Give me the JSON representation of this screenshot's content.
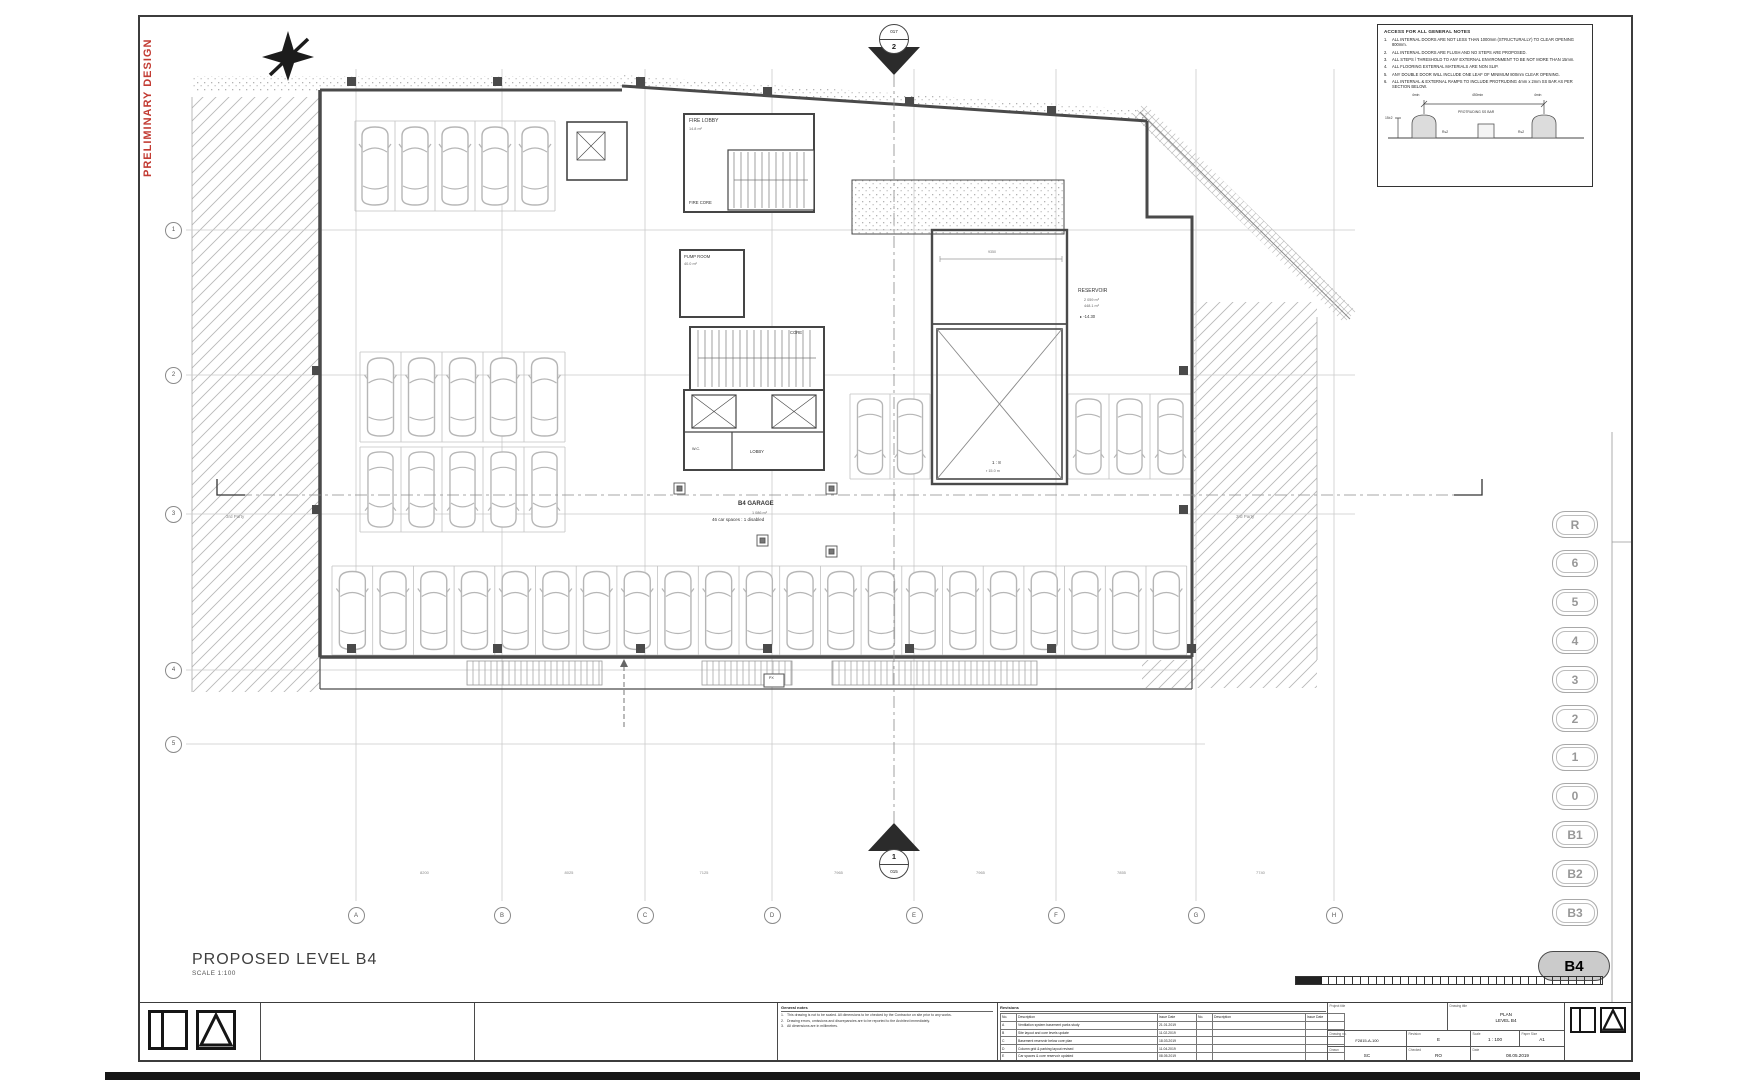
{
  "stamp": "PRELIMINARY DESIGN",
  "sheet_title": {
    "name": "PROPOSED LEVEL B4",
    "scale": "SCALE 1:100"
  },
  "section_markers": {
    "top_sheet": "017",
    "top_num": "2",
    "bottom_num": "1",
    "bottom_sheet": "015"
  },
  "grid": {
    "cols": [
      "A",
      "B",
      "C",
      "D",
      "E",
      "F",
      "G",
      "H"
    ],
    "rows": [
      "1",
      "2",
      "3",
      "4",
      "5"
    ]
  },
  "dims_bottom": [
    "8200",
    "8025",
    "7125",
    "7965",
    "7965",
    "7855",
    "7740"
  ],
  "notes_box": {
    "title": "ACCESS FOR ALL GENERAL NOTES",
    "items": [
      "ALL INTERNAL DOORS ARE NOT LESS THAN 1000mm (STRUCTURALLY) TO CLEAR OPENING 800mm.",
      "ALL INTERNAL DOORS ARE FLUSH AND NO STEPS ARE PROPOSED.",
      "ALL STEPS / THRESHOLD TO ANY EXTERNAL ENVIRONMENT TO BE NOT MORE THAN 15mm.",
      "ALL FLOORING EXTERNAL MATERIALS ARE NON SLIP.",
      "ANY DOUBLE DOOR WILL INCLUDE ONE LEAF OF MINIMUM 800mm CLEAR OPENING.",
      "ALL INTERNAL & EXTERNAL RAMPS TO INCLUDE PROTRUDING 4mm x 2mm SS BAR AS PER SECTION BELOW."
    ],
    "detail": {
      "dim_left": "4min",
      "dim_mid": "450min",
      "dim_right": "4min",
      "label": "PROTRUDING SS BAR",
      "side": "R≤2",
      "height": "15±2"
    }
  },
  "levels": [
    {
      "l": "R"
    },
    {
      "l": "6"
    },
    {
      "l": "5"
    },
    {
      "l": "4"
    },
    {
      "l": "3"
    },
    {
      "l": "2"
    },
    {
      "l": "1"
    },
    {
      "l": "0"
    },
    {
      "l": "B1"
    },
    {
      "l": "B2"
    },
    {
      "l": "B3"
    },
    {
      "l": "B4",
      "active": true
    }
  ],
  "plan_labels": [
    {
      "t": "FIRE LOBBY",
      "x": 549,
      "y": 102,
      "s": 5
    },
    {
      "t": "14.8 m²",
      "x": 549,
      "y": 110,
      "s": 3.8,
      "c": "#666"
    },
    {
      "t": "FIRE CORE",
      "x": 549,
      "y": 184,
      "s": 4.2
    },
    {
      "t": "PUMP ROOM",
      "x": 544,
      "y": 238,
      "s": 4.2
    },
    {
      "t": "40.0 m²",
      "x": 544,
      "y": 245,
      "s": 3.8,
      "c": "#666"
    },
    {
      "t": "CORE",
      "x": 650,
      "y": 314,
      "s": 4.2
    },
    {
      "t": "W.C.",
      "x": 552,
      "y": 430,
      "s": 3.8
    },
    {
      "t": "LOBBY",
      "x": 610,
      "y": 433,
      "s": 4.2
    },
    {
      "t": "B4 GARAGE",
      "x": 598,
      "y": 484,
      "s": 6,
      "b": 1
    },
    {
      "t": "1 086 m²",
      "x": 612,
      "y": 494,
      "s": 3.8,
      "c": "#666"
    },
    {
      "t": "46 car spaces : 1 disabled",
      "x": 572,
      "y": 501,
      "s": 4.5
    },
    {
      "t": "RESERVOIR",
      "x": 938,
      "y": 272,
      "s": 5
    },
    {
      "t": "2 059 m³",
      "x": 944,
      "y": 281,
      "s": 3.8,
      "c": "#666"
    },
    {
      "t": "448.1 m²",
      "x": 944,
      "y": 287,
      "s": 3.8,
      "c": "#666"
    },
    {
      "t": "▸ -14.30",
      "x": 940,
      "y": 298,
      "s": 4.2
    },
    {
      "t": "1 : 8",
      "x": 852,
      "y": 444,
      "s": 4.5
    },
    {
      "t": "r 15.0 m",
      "x": 846,
      "y": 452,
      "s": 3.8,
      "c": "#666"
    },
    {
      "t": "3rd Party",
      "x": 86,
      "y": 498,
      "s": 4.5,
      "c": "#8a8a8a"
    },
    {
      "t": "3rd Party",
      "x": 1096,
      "y": 498,
      "s": 4.5,
      "c": "#8a8a8a"
    },
    {
      "t": "PX",
      "x": 629,
      "y": 660,
      "s": 3.6
    },
    {
      "t": "9350",
      "x": 848,
      "y": 234,
      "s": 3.6,
      "c": "#777"
    }
  ],
  "parking": {
    "rows": [
      {
        "x": 215,
        "y": 104,
        "n": 5,
        "w": 40,
        "h": 90
      },
      {
        "x": 220,
        "y": 335,
        "n": 5,
        "w": 41,
        "h": 90
      },
      {
        "x": 220,
        "y": 430,
        "n": 5,
        "w": 41,
        "h": 85,
        "flip": 1
      },
      {
        "x": 710,
        "y": 377,
        "n": 2,
        "w": 40,
        "h": 85,
        "flip": 1
      },
      {
        "x": 928,
        "y": 377,
        "n": 3,
        "w": 41,
        "h": 85,
        "flip": 1
      },
      {
        "x": 192,
        "y": 549,
        "n": 21,
        "w": 40.7,
        "h": 89
      }
    ]
  },
  "titleblock": {
    "general_notes_header": "General notes",
    "general_notes": [
      "This drawing is not to be scaled. All dimensions to be checked by the Contractor on site prior to any works.",
      "Drawing errors, omissions and discrepancies are to be reported to the Architect immediately.",
      "All dimensions are in millimetres."
    ],
    "revisions_header": "Revisions",
    "rev_cols": [
      "No.",
      "Description",
      "Issue Date",
      "No.",
      "Description",
      "Issue Date"
    ],
    "rev_rows": [
      [
        "A",
        "Ventilation system basement parks study",
        "21.01.2019"
      ],
      [
        "B",
        "Site layout and core levels update",
        "11.02.2019"
      ],
      [
        "C",
        "Basement reservoir below core plan",
        "18.03.2019"
      ],
      [
        "D",
        "Column grid & parking layout revised",
        "11.04.2019"
      ],
      [
        "E",
        "Car spaces & core reservoir updated",
        "08.05.2019"
      ]
    ],
    "project_title_label": "Project title",
    "drawing_title_label": "Drawing title",
    "drawing_title": [
      "PLAN",
      "LEVEL B4"
    ],
    "cells": [
      {
        "label": "Drawing no.",
        "value": "F2815-A-100"
      },
      {
        "label": "Revision",
        "value": "E"
      },
      {
        "label": "Scale",
        "value": "1 : 100"
      },
      {
        "label": "Paper Size",
        "value": "A1"
      },
      {
        "label": "Drawn",
        "value": "SC"
      },
      {
        "label": "Checked",
        "value": "RO"
      },
      {
        "label": "Date",
        "value": "08.05.2019"
      }
    ]
  }
}
